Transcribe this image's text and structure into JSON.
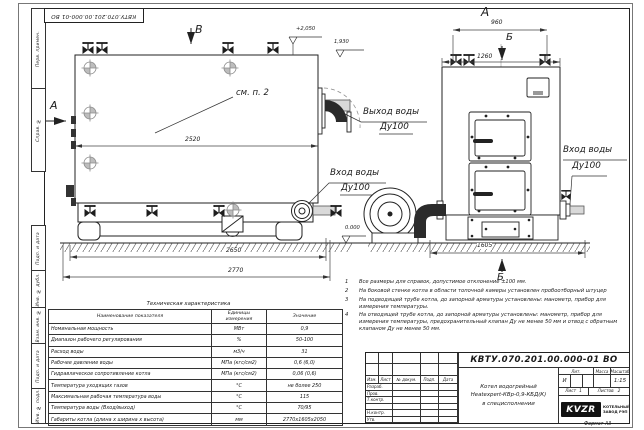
{
  "frame": {
    "doc_number_rotated": "КВТУ.070.201.00.000-01 ВО",
    "format_label": "Формат А3",
    "stamp_labels": [
      "Перв. примен.",
      "Справ. №",
      "Подп. и дата",
      "Инв. № дубл.",
      "Взам. инв. №",
      "Подп. и дата",
      "Инв. № подл."
    ]
  },
  "drawing": {
    "view_b_label": "В",
    "view_a_arrow_label": "А",
    "front_view_label": "А",
    "section_label_top": "Б",
    "section_label_bottom": "Б",
    "see_note_label": "см. п. 2",
    "dim_2520": "2520",
    "dim_2650": "2650",
    "dim_2770": "2770",
    "dim_960": "960",
    "dim_1260": "1260",
    "dim_1605": "1605",
    "elev_top": "+2,050",
    "elev_outlet": "1,930",
    "elev_ground": "0.000",
    "outlet_line1": "Выход воды",
    "outlet_line2": "Ду100",
    "inlet_side_line1": "Вход воды",
    "inlet_side_line2": "Ду100",
    "inlet_front_line1": "Вход воды",
    "inlet_front_line2": "Ду100"
  },
  "notes": [
    {
      "n": "1",
      "t": "Все размеры для справок, допустимое отклонение ±100 мм."
    },
    {
      "n": "2",
      "t": "На боковой стенке котла в области топочной камеры установлен пробоотборный штуцер"
    },
    {
      "n": "3",
      "t": "На подводящей трубе котла, до запорной арматуры установлены: манометр, прибор для измерения температуры."
    },
    {
      "n": "4",
      "t": "На отводящей трубе котла, до запорной арматуры установлены: манометр, прибор для измерения температуры, предохранительный клапан Ду не менее 50 мм и отвод с обратным клапаном Ду не менее 50 мм."
    }
  ],
  "spec_table": {
    "title": "Техническая характеристика",
    "headers": [
      "Наименование показателя",
      "Единицы измерения",
      "Значение"
    ],
    "rows": [
      [
        "Номинальная мощность",
        "МВт",
        "0,9"
      ],
      [
        "Диапазон рабочего регулирования",
        "%",
        "50-100"
      ],
      [
        "Расход воды",
        "м3/ч",
        "31"
      ],
      [
        "Рабочее давление воды",
        "МПа (кгс/см2)",
        "0,6 (6,0)"
      ],
      [
        "Гидравлическое сопротивление котла",
        "МПа (кгс/см2)",
        "0,06 (0,6)"
      ],
      [
        "Температура уходящих газов",
        "°С",
        "не более 250"
      ],
      [
        "Максимальная рабочая температура воды",
        "°С",
        "115"
      ],
      [
        "Температура воды (Вход/выход)",
        "°С",
        "70/95"
      ],
      [
        "Габариты котла (длина х ширина х высота)",
        "мм",
        "2770х1605х2050"
      ]
    ]
  },
  "title_block": {
    "doc_number": "КВТУ.070.201.00.000-01 ВО",
    "sig_headers": [
      "Изм.",
      "Лист",
      "№ докум.",
      "Подп.",
      "Дата"
    ],
    "sig_rows": [
      "Разраб.",
      "Пров.",
      "Т.контр.",
      "",
      "Н.контр.",
      "Утв."
    ],
    "product_line1": "Котел водогрейный",
    "product_line2": "Heatexpert-КВр-0,9-КБД(К)",
    "product_line3": "в специсполнении",
    "lit_header": "Лит.",
    "mass_header": "Масса",
    "scale_header": "Масштаб",
    "lit_value": "И",
    "scale_value": "1:15",
    "sheet_label": "Лист",
    "sheet_value": "1",
    "sheets_label": "Листов",
    "sheets_value": "2",
    "logo_text": "KVZR",
    "company_line1": "КОТЕЛЬНЫЙ",
    "company_line2": "ЗАВОД РЭП"
  }
}
